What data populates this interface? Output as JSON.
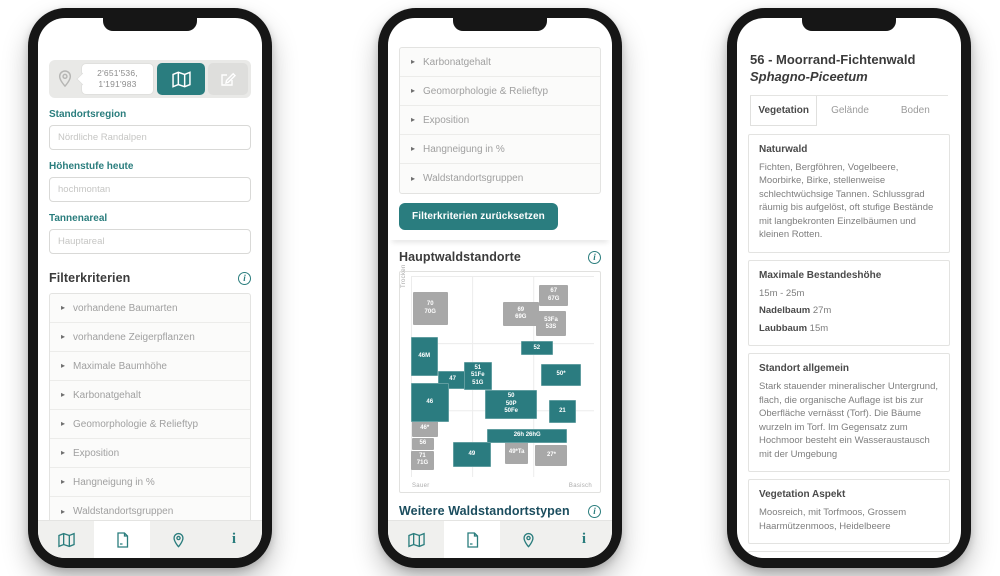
{
  "colors": {
    "teal": "#2a7d7f",
    "teal_dark_heading": "#1b4d5e",
    "chart_teal": "#2b7c80",
    "chart_gray": "#a8a8a8"
  },
  "nav": {
    "active_index": 1,
    "items": [
      {
        "icon": "map-icon"
      },
      {
        "icon": "document-icon"
      },
      {
        "icon": "pin-icon"
      },
      {
        "icon": "info-icon"
      }
    ]
  },
  "phone1": {
    "coords_line1": "2'651'536,",
    "coords_line2": "1'191'983",
    "fields": [
      {
        "label": "Standortsregion",
        "placeholder": "Nördliche Randalpen"
      },
      {
        "label": "Höhenstufe heute",
        "placeholder": "hochmontan"
      },
      {
        "label": "Tannenareal",
        "placeholder": "Hauptareal"
      }
    ],
    "filter_title": "Filterkriterien",
    "filter_items": [
      "vorhandene Baumarten",
      "vorhandene Zeigerpflanzen",
      "Maximale Baumhöhe",
      "Karbonatgehalt",
      "Geomorphologie & Relieftyp",
      "Exposition",
      "Hangneigung in %",
      "Waldstandortsgruppen"
    ]
  },
  "phone2": {
    "list_items": [
      "Karbonatgehalt",
      "Geomorphologie & Relieftyp",
      "Exposition",
      "Hangneigung in %",
      "Waldstandortsgruppen"
    ],
    "reset_label": "Filterkriterien zurücksetzen",
    "chart_title": "Hauptwaldstandorte",
    "more_title": "Weitere Waldstandortstypen",
    "select_placeholder": "Bitte aus der Liste auswählen",
    "chart_data": {
      "type": "heatmap",
      "title": "Hauptwaldstandorte",
      "y_axis_top_label": "Trocken",
      "x_axis_left_label": "Sauer",
      "x_axis_right_label": "Basisch",
      "boxes": [
        {
          "lines": [
            "70",
            "70G"
          ],
          "state": "gray",
          "x": 1,
          "y": 8,
          "w": 19,
          "h": 16.5
        },
        {
          "lines": [
            "67",
            "67G"
          ],
          "state": "gray",
          "x": 70,
          "y": 4.5,
          "w": 16,
          "h": 10.5
        },
        {
          "lines": [
            "69",
            "69G"
          ],
          "state": "gray",
          "x": 50,
          "y": 13,
          "w": 20,
          "h": 12
        },
        {
          "lines": [
            "53Fa",
            "53S"
          ],
          "state": "gray",
          "x": 68.5,
          "y": 17.5,
          "w": 16,
          "h": 12.5
        },
        {
          "lines": [
            "46*"
          ],
          "state": "gray",
          "x": 0.5,
          "y": 72,
          "w": 14,
          "h": 8
        },
        {
          "lines": [
            "56"
          ],
          "state": "gray",
          "x": 0.5,
          "y": 80.5,
          "w": 12,
          "h": 6
        },
        {
          "lines": [
            "71",
            "71G"
          ],
          "state": "gray",
          "x": 0,
          "y": 87,
          "w": 12.5,
          "h": 9.5
        },
        {
          "lines": [
            "49*Ta"
          ],
          "state": "gray",
          "x": 51.5,
          "y": 82,
          "w": 12.5,
          "h": 11.5
        },
        {
          "lines": [
            "27*"
          ],
          "state": "gray",
          "x": 68,
          "y": 84,
          "w": 17.5,
          "h": 10.5
        },
        {
          "lines": [
            "46M"
          ],
          "state": "teal",
          "x": 0,
          "y": 30.5,
          "w": 14.5,
          "h": 19.5
        },
        {
          "lines": [
            "47"
          ],
          "state": "teal",
          "x": 14.5,
          "y": 47.5,
          "w": 16.5,
          "h": 8.5
        },
        {
          "lines": [
            "51",
            "51Fe",
            "51G"
          ],
          "state": "teal",
          "x": 29,
          "y": 43,
          "w": 15,
          "h": 13.5
        },
        {
          "lines": [
            "52"
          ],
          "state": "teal",
          "x": 60,
          "y": 32.5,
          "w": 17.5,
          "h": 7
        },
        {
          "lines": [
            "50*"
          ],
          "state": "teal",
          "x": 71,
          "y": 44,
          "w": 22,
          "h": 10.5
        },
        {
          "lines": [
            "46"
          ],
          "state": "teal",
          "x": 0,
          "y": 53,
          "w": 20.5,
          "h": 19.5
        },
        {
          "lines": [
            "50",
            "50P",
            "50Fe"
          ],
          "state": "teal",
          "x": 40.5,
          "y": 56.5,
          "w": 28.5,
          "h": 14.5
        },
        {
          "lines": [
            "21"
          ],
          "state": "teal",
          "x": 75.5,
          "y": 61.5,
          "w": 14.5,
          "h": 11.5
        },
        {
          "lines": [
            "26h 26hG"
          ],
          "state": "teal",
          "x": 41.5,
          "y": 76,
          "w": 44,
          "h": 7
        },
        {
          "lines": [
            "49"
          ],
          "state": "teal",
          "x": 23,
          "y": 82.5,
          "w": 20.5,
          "h": 12.5
        }
      ]
    }
  },
  "phone3": {
    "title": "56 - Moorrand-Fichtenwald",
    "subtitle": "Sphagno-Piceetum",
    "active_tab_index": 0,
    "tabs": [
      {
        "label": "Vegetation"
      },
      {
        "label": "Gelände"
      },
      {
        "label": "Boden"
      }
    ],
    "sections": [
      {
        "heading": "Naturwald",
        "lines": [
          [
            {
              "t": "Fichten, Bergföhren, Vogelbeere, Moorbirke, Birke, stellenweise schlechtwüchsige Tannen. Schlussgrad räumig bis aufgelöst, oft stufige Bestände mit langbekronten Einzelbäumen und kleinen Rotten."
            }
          ]
        ]
      },
      {
        "heading": "Maximale Bestandeshöhe",
        "lines": [
          [
            {
              "t": "15m - 25m"
            }
          ],
          [
            {
              "b": "Nadelbaum"
            },
            {
              "t": " 27m"
            }
          ],
          [
            {
              "b": "Laubbaum"
            },
            {
              "t": " 15m"
            }
          ]
        ]
      },
      {
        "heading": "Standort allgemein",
        "lines": [
          [
            {
              "t": "Stark stauender mineralischer Untergrund, flach, die organische Auflage ist bis zur Oberfläche vernässt (Torf). Die Bäume wurzeln im Torf. Im Gegensatz zum Hochmoor besteht ein Wasseraustausch mit der Umgebung"
            }
          ]
        ]
      },
      {
        "heading": "Vegetation Aspekt",
        "lines": [
          [
            {
              "t": "Moosreich, mit Torfmoos, Grossem Haarmützenmoos, Heidelbeere"
            }
          ]
        ]
      },
      {
        "heading": "Dominante Naturwaldbaumart",
        "lines": [
          [
            {
              "t": "Fichte ("
            },
            {
              "i": "Picea abies"
            },
            {
              "t": ")"
            }
          ]
        ]
      }
    ]
  }
}
